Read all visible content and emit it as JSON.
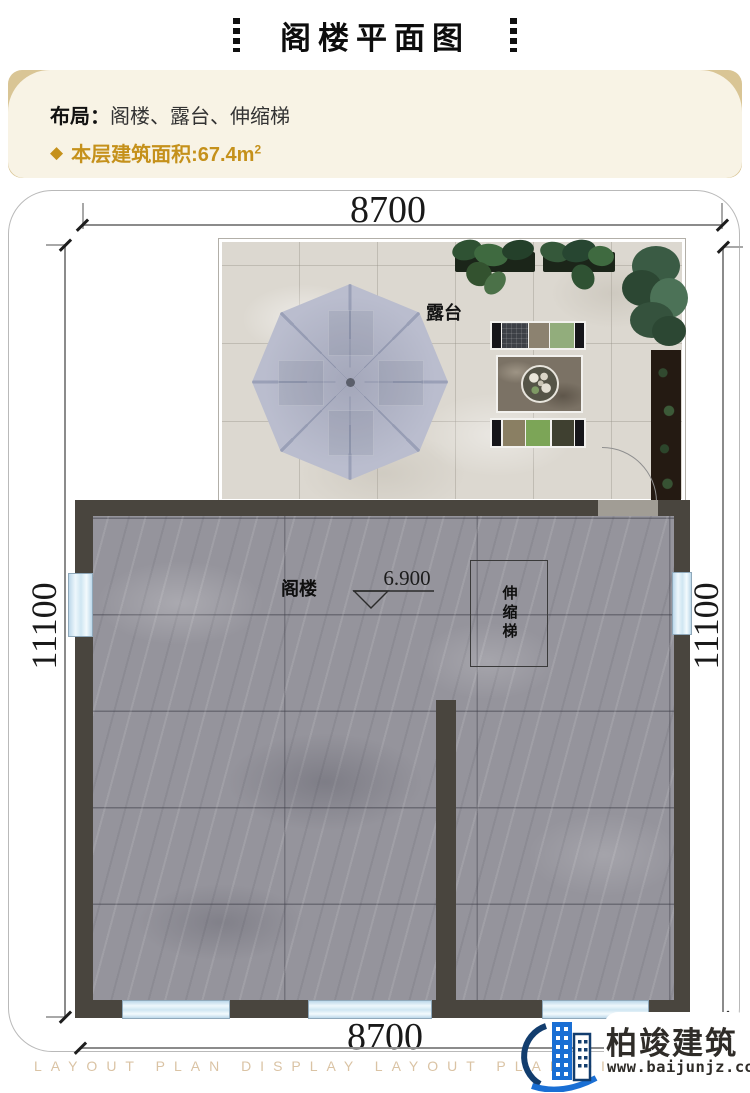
{
  "page": {
    "title": "阁楼平面图"
  },
  "info_box": {
    "layout_label": "布局：",
    "layout_value": "阁楼、露台、伸缩梯",
    "diamond_icon": "◆",
    "area_text": "本层建筑面积:67.4m",
    "area_superscript": "2"
  },
  "plan": {
    "dim_top": "8700",
    "dim_bottom": "8700",
    "dim_left": "11100",
    "dim_right": "11100",
    "terrace_label": "露台",
    "attic_label": "阁楼",
    "elevation_value": "6.900",
    "ladder_label": "伸缩梯"
  },
  "watermark_text": "LAYOUT PLAN DISPLAY LAYOUT PLAN DISPLAY",
  "logo": {
    "brand_name": "柏竣建筑",
    "website": "www.baijunjz.com"
  },
  "colors": {
    "accent_gold": "#c5911b",
    "cream_bg": "#f8f3e5",
    "tan_accent": "#d9c595",
    "wall_dark": "#49453e",
    "window_blue": "#cfe6f2",
    "umbrella_lavender": "#babdce",
    "brand_blue": "#1a6fd4"
  }
}
